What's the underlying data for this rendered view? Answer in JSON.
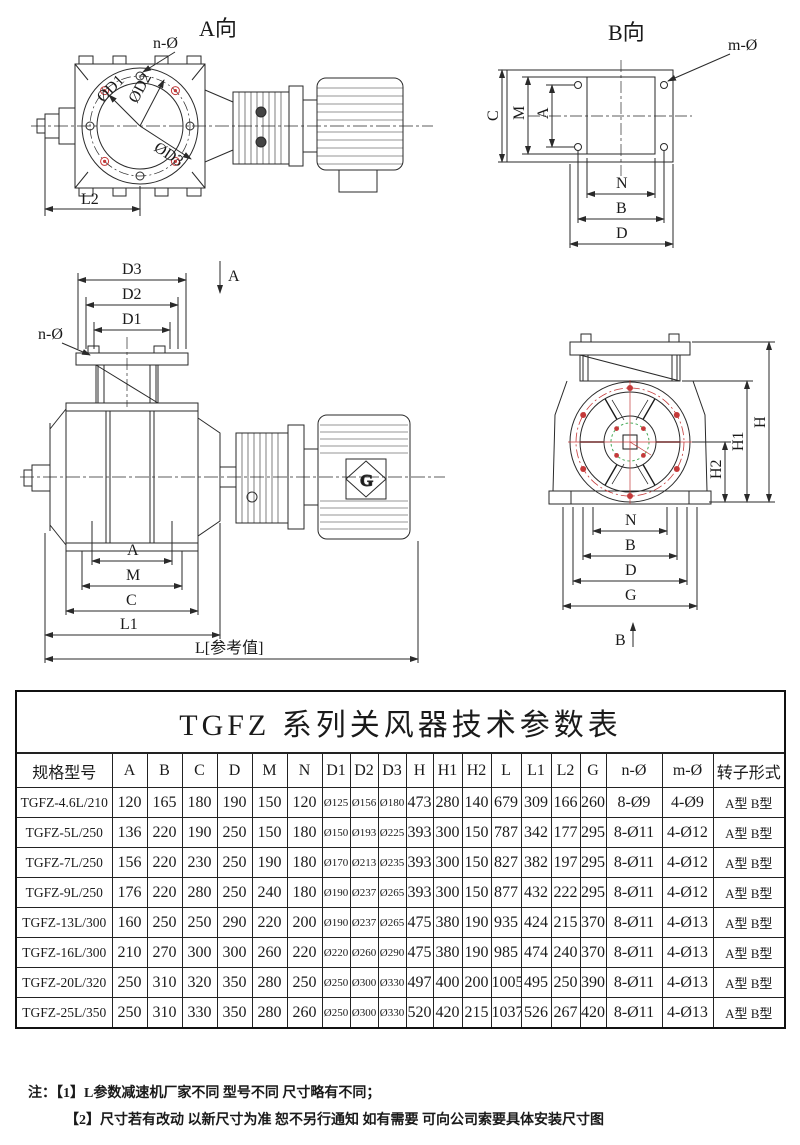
{
  "colors": {
    "line": "#2a2a2a",
    "accent_red": "#c43a3a",
    "accent_green": "#4aaa5a"
  },
  "drawings": {
    "view_a": {
      "title": "A向",
      "n_hole": "n-Ø",
      "d1": "ØD1",
      "d2": "ØD2",
      "d3": "ØD3",
      "l2": "L2"
    },
    "view_b": {
      "title": "B向",
      "m_hole": "m-Ø",
      "dim_c": "C",
      "dim_m": "M",
      "dim_a": "A",
      "dim_n": "N",
      "dim_b": "B",
      "dim_d": "D"
    },
    "front": {
      "section_label": "A",
      "n_hole": "n-Ø",
      "dim_d3": "D3",
      "dim_d2": "D2",
      "dim_d1": "D1",
      "dim_a": "A",
      "dim_m": "M",
      "dim_c": "C",
      "dim_l1": "L1",
      "dim_l": "L[参考值]",
      "motor_logo": "G"
    },
    "end": {
      "dim_h": "H",
      "dim_h1": "H1",
      "dim_h2": "H2",
      "dim_n": "N",
      "dim_b": "B",
      "dim_d": "D",
      "dim_g": "G",
      "section_label": "B"
    }
  },
  "table": {
    "title": "TGFZ 系列关风器技术参数表",
    "headers": [
      "规格型号",
      "A",
      "B",
      "C",
      "D",
      "M",
      "N",
      "D1",
      "D2",
      "D3",
      "H",
      "H1",
      "H2",
      "L",
      "L1",
      "L2",
      "G",
      "n-Ø",
      "m-Ø",
      "转子形式"
    ],
    "rows": [
      [
        "TGFZ-4.6L/210",
        "120",
        "165",
        "180",
        "190",
        "150",
        "120",
        "Ø125",
        "Ø156",
        "Ø180",
        "473",
        "280",
        "140",
        "679",
        "309",
        "166",
        "260",
        "8-Ø9",
        "4-Ø9",
        "A型 B型"
      ],
      [
        "TGFZ-5L/250",
        "136",
        "220",
        "190",
        "250",
        "150",
        "180",
        "Ø150",
        "Ø193",
        "Ø225",
        "393",
        "300",
        "150",
        "787",
        "342",
        "177",
        "295",
        "8-Ø11",
        "4-Ø12",
        "A型 B型"
      ],
      [
        "TGFZ-7L/250",
        "156",
        "220",
        "230",
        "250",
        "190",
        "180",
        "Ø170",
        "Ø213",
        "Ø235",
        "393",
        "300",
        "150",
        "827",
        "382",
        "197",
        "295",
        "8-Ø11",
        "4-Ø12",
        "A型 B型"
      ],
      [
        "TGFZ-9L/250",
        "176",
        "220",
        "280",
        "250",
        "240",
        "180",
        "Ø190",
        "Ø237",
        "Ø265",
        "393",
        "300",
        "150",
        "877",
        "432",
        "222",
        "295",
        "8-Ø11",
        "4-Ø12",
        "A型 B型"
      ],
      [
        "TGFZ-13L/300",
        "160",
        "250",
        "250",
        "290",
        "220",
        "200",
        "Ø190",
        "Ø237",
        "Ø265",
        "475",
        "380",
        "190",
        "935",
        "424",
        "215",
        "370",
        "8-Ø11",
        "4-Ø13",
        "A型 B型"
      ],
      [
        "TGFZ-16L/300",
        "210",
        "270",
        "300",
        "300",
        "260",
        "220",
        "Ø220",
        "Ø260",
        "Ø290",
        "475",
        "380",
        "190",
        "985",
        "474",
        "240",
        "370",
        "8-Ø11",
        "4-Ø13",
        "A型 B型"
      ],
      [
        "TGFZ-20L/320",
        "250",
        "310",
        "320",
        "350",
        "280",
        "250",
        "Ø250",
        "Ø300",
        "Ø330",
        "497",
        "400",
        "200",
        "1005",
        "495",
        "250",
        "390",
        "8-Ø11",
        "4-Ø13",
        "A型 B型"
      ],
      [
        "TGFZ-25L/350",
        "250",
        "310",
        "330",
        "350",
        "280",
        "260",
        "Ø250",
        "Ø300",
        "Ø330",
        "520",
        "420",
        "215",
        "1037",
        "526",
        "267",
        "420",
        "8-Ø11",
        "4-Ø13",
        "A型 B型"
      ]
    ]
  },
  "notes": {
    "prefix": "注：",
    "items": [
      "【1】L参数减速机厂家不同 型号不同 尺寸略有不同；",
      "【2】尺寸若有改动 以新尺寸为准 恕不另行通知 如有需要 可向公司索要具体安装尺寸图"
    ]
  }
}
